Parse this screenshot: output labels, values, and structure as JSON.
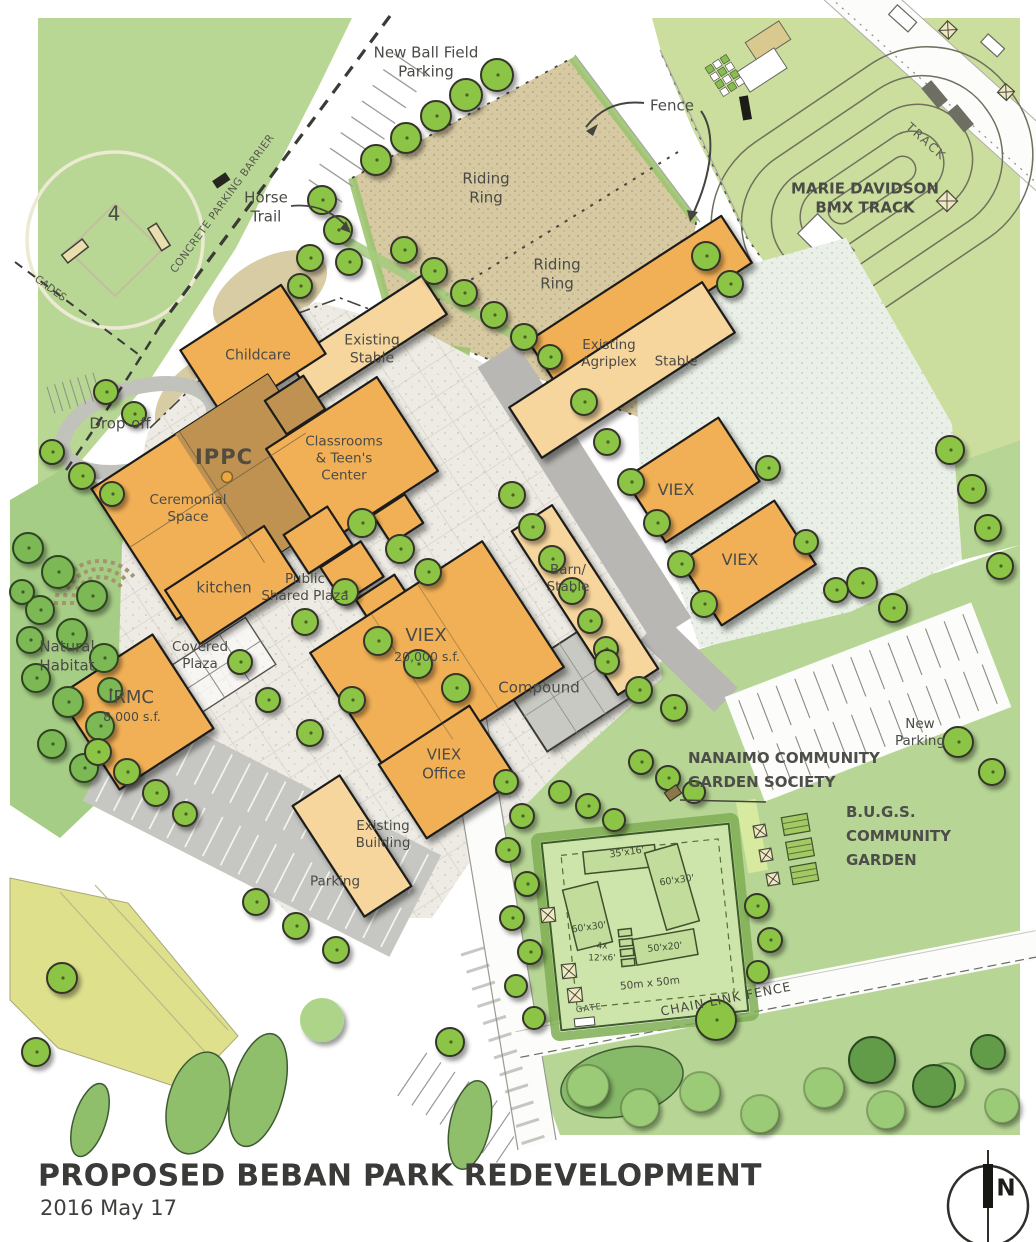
{
  "labels": {
    "new_ball_field_parking": "New Ball Field\nParking",
    "fence": "Fence",
    "track": "TRACK",
    "bmx_track": "MARIE DAVIDSON\nBMX TRACK",
    "riding_ring_1": "Riding\nRing",
    "riding_ring_2": "Riding\nRing",
    "horse_trail": "Horse\nTrail",
    "concrete_parking_barrier": "CONCRETE PARKING BARRIER",
    "ball_field_number": "4",
    "barricades_partial": "CADES",
    "childcare": "Childcare",
    "existing_stable": "Existing\nStable",
    "drop_off": "Drop-off",
    "ippc": "IPPC",
    "ceremonial_space": "Ceremonial\nSpace",
    "classrooms_teens_center": "Classrooms\n& Teen's\nCenter",
    "kitchen": "kitchen",
    "public_shared_plaza": "Public\nShared Plaza",
    "natural_habitat": "Natural\nHabitat",
    "covered_plaza": "Covered\nPlaza",
    "irmc": "IRMC",
    "irmc_size": "8,000 s.f.",
    "viex_main": "VIEX",
    "viex_main_size": "20,000 s.f.",
    "compound": "Compound",
    "barn_stable": "Barn/\nStable",
    "existing_agriplex": "Existing\nAgriplex",
    "stable": "Stable",
    "viex_east_1": "VIEX",
    "viex_east_2": "VIEX",
    "viex_office": "VIEX\nOffice",
    "existing_building": "Existing\nBuilding",
    "parking": "Parking",
    "new_parking": "New\nParking",
    "nanaimo_community_garden": "NANAIMO COMMUNITY\nGARDEN SOCIETY",
    "bugs_community_garden": "B.U.G.S.\nCOMMUNITY\nGARDEN",
    "plot_35x16": "35'x16'",
    "plot_60x30_a": "60'x30'",
    "plot_60x30_b": "60'x30'",
    "plot_4x_12x6": "4x\n12'x6'",
    "plot_50x20": "50'x20'",
    "garden_dimensions": "50m x 50m",
    "gate": "GATE",
    "chain_link_fence": "CHAIN LINK FENCE"
  },
  "title_block": {
    "title": "PROPOSED BEBAN PARK REDEVELOPMENT",
    "date": "2016 May 17"
  },
  "north": {
    "letter": "N"
  },
  "colors": {
    "building_new": "#F2B057",
    "building_existing": "#F7D69E",
    "ippc_shade": "#BF9251",
    "sand": "#D7CAA2",
    "park_green": "#B8D794",
    "bmx_green": "#CBDE9D",
    "habitat_green": "#A6CD86",
    "garden_green": "#B7D695",
    "tree_green": "#8CC544",
    "road_gray": "#B8B7B3",
    "plaza_gray": "#EDEBE4",
    "label_text": "#4A4A46"
  }
}
